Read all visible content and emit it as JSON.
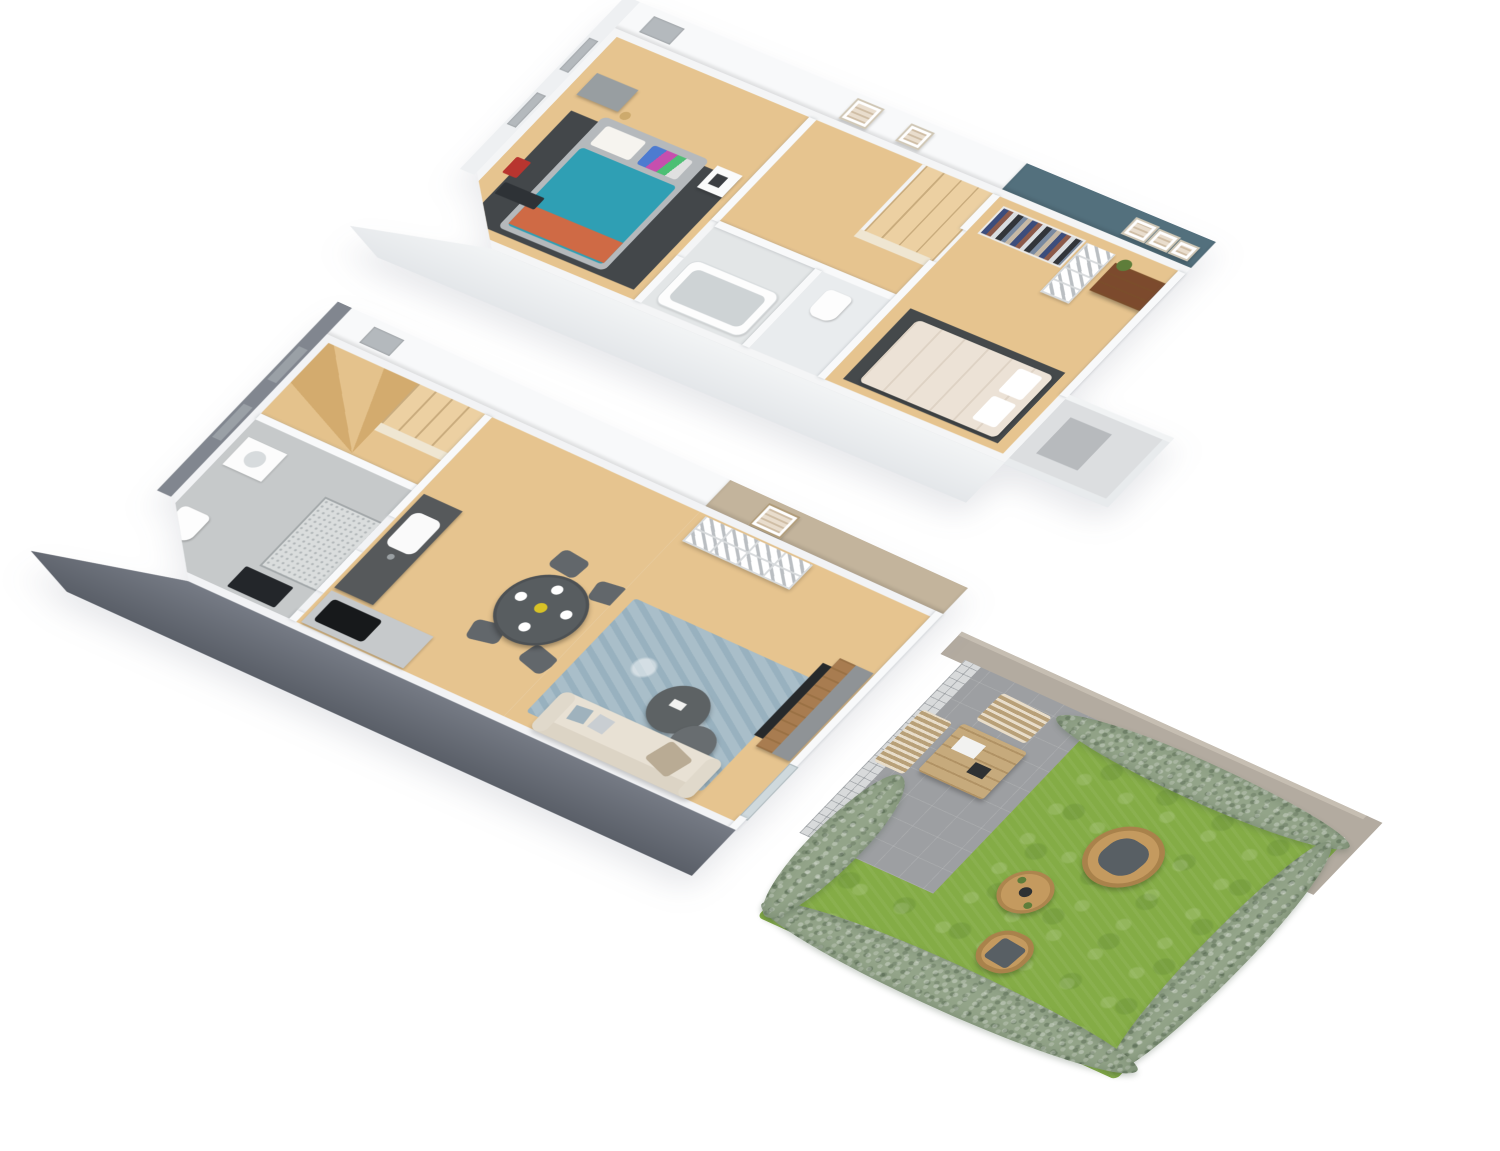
{
  "scene": {
    "type": "3d-floorplan-render",
    "description": "isometric dollhouse view of a two-storey duplex with garden",
    "background": "#ffffff"
  },
  "palette": {
    "wallWhite": "#f4f5f6",
    "wallFace": "#eef0f2",
    "exteriorWall": "#6e737e",
    "exteriorFace": "#81868f",
    "woodFloor": "#e6c48f",
    "woodStair": "#ecd0a2",
    "tileGray": "#c6c9ca",
    "tileLight": "#e3e6e7",
    "wcTile": "#e9ecee",
    "tealAccentWall": "#53707d",
    "beigeAccentWall": "#c3b49c",
    "rugDark": "#43474a",
    "rugDark2": "#45494b",
    "rugBlue": "#a9bec9",
    "bedTeal": "#2f9fb4",
    "bedOrange": "#cf6a45",
    "bedCream": "#ece2d6",
    "bedFrame": "#b5b9bc",
    "sofaBeige": "#e8e1d4",
    "diningTable": "#585d60",
    "chairGray": "#62676b",
    "coffeeTable": "#5d6264",
    "grassGreen": "#84ac46",
    "hedgeGreen": "#93a489",
    "patioGray": "#9d9fa2",
    "gardenWall": "#b3aba0",
    "rattanTan": "#c49a5f",
    "rattanLight": "#cdb489",
    "outdoorWood": "#c6aa7c",
    "cushionGray": "#585f64",
    "dresserBrown": "#7c4a2d",
    "dresserGray": "#989ea1",
    "consoleWood": "#a87c50",
    "consoleGray": "#8f9396",
    "tvBlack": "#26292b",
    "cooktopBlack": "#17191b",
    "counterDark": "#56595b",
    "counterFront": "#c6c9cb",
    "shelfWhite": "#ffffff",
    "balconyFloor": "#dcdee0",
    "balconyMat": "#b7babd",
    "windowGray": "#b4b9bd",
    "windowDark": "#9aa0a6",
    "redAccent": "#b8352f",
    "matBlack": "#23262a",
    "showerTile": "#dadddd",
    "tubWhite": "#fdfdfd",
    "tubInner": "#ced3d5",
    "glassDoor": "#cfd9dd",
    "plantGreen": "#5e7d3a",
    "flowerYellow": "#d8c227"
  },
  "floors": {
    "upper": {
      "label": "upper-floor",
      "rooms": [
        "bedroom-1",
        "landing",
        "bathroom",
        "wc",
        "bedroom-2",
        "balcony"
      ],
      "furniture": {
        "bedroom_1": [
          "double-bed-teal-orange",
          "dark-rug",
          "gray-dresser",
          "white-nightstand",
          "floor-lamp",
          "red-bag",
          "dark-clothes",
          "wall-art"
        ],
        "landing": [
          "stair-opening",
          "stair-railing"
        ],
        "bathroom": [
          "bathtub"
        ],
        "wc": [
          "toilet"
        ],
        "bedroom_2": [
          "double-bed-cream",
          "dark-rug",
          "clothes-rack",
          "cube-shelf",
          "wood-dresser",
          "plant",
          "wall-art"
        ],
        "balcony": [
          "lattice-railing",
          "floor-mat"
        ]
      }
    },
    "lower": {
      "label": "lower-floor",
      "rooms": [
        "stairwell",
        "bathroom",
        "kitchen",
        "dining-area",
        "living-room"
      ],
      "furniture": {
        "stairwell": [
          "winder-stairs",
          "straight-run",
          "railing"
        ],
        "bathroom": [
          "walk-in-shower",
          "vanity",
          "toilet",
          "door-mat"
        ],
        "kitchen": [
          "sink-counter",
          "sink",
          "front-counter",
          "cooktop"
        ],
        "dining_area": [
          "round-table",
          "four-chairs",
          "plates",
          "flowers"
        ],
        "living_room": [
          "cube-shelf",
          "wall-art",
          "blue-rug",
          "coffee-table-large",
          "coffee-table-small",
          "tv-console",
          "tv",
          "sofa",
          "pillows",
          "glass-door"
        ]
      }
    }
  },
  "garden": {
    "label": "garden",
    "elements": [
      "boundary-wall",
      "hedges",
      "lawn",
      "patio",
      "outdoor-dining-table",
      "outdoor-chair",
      "outdoor-bench",
      "egg-chair",
      "rattan-side-table",
      "rattan-lounge-chair"
    ]
  }
}
